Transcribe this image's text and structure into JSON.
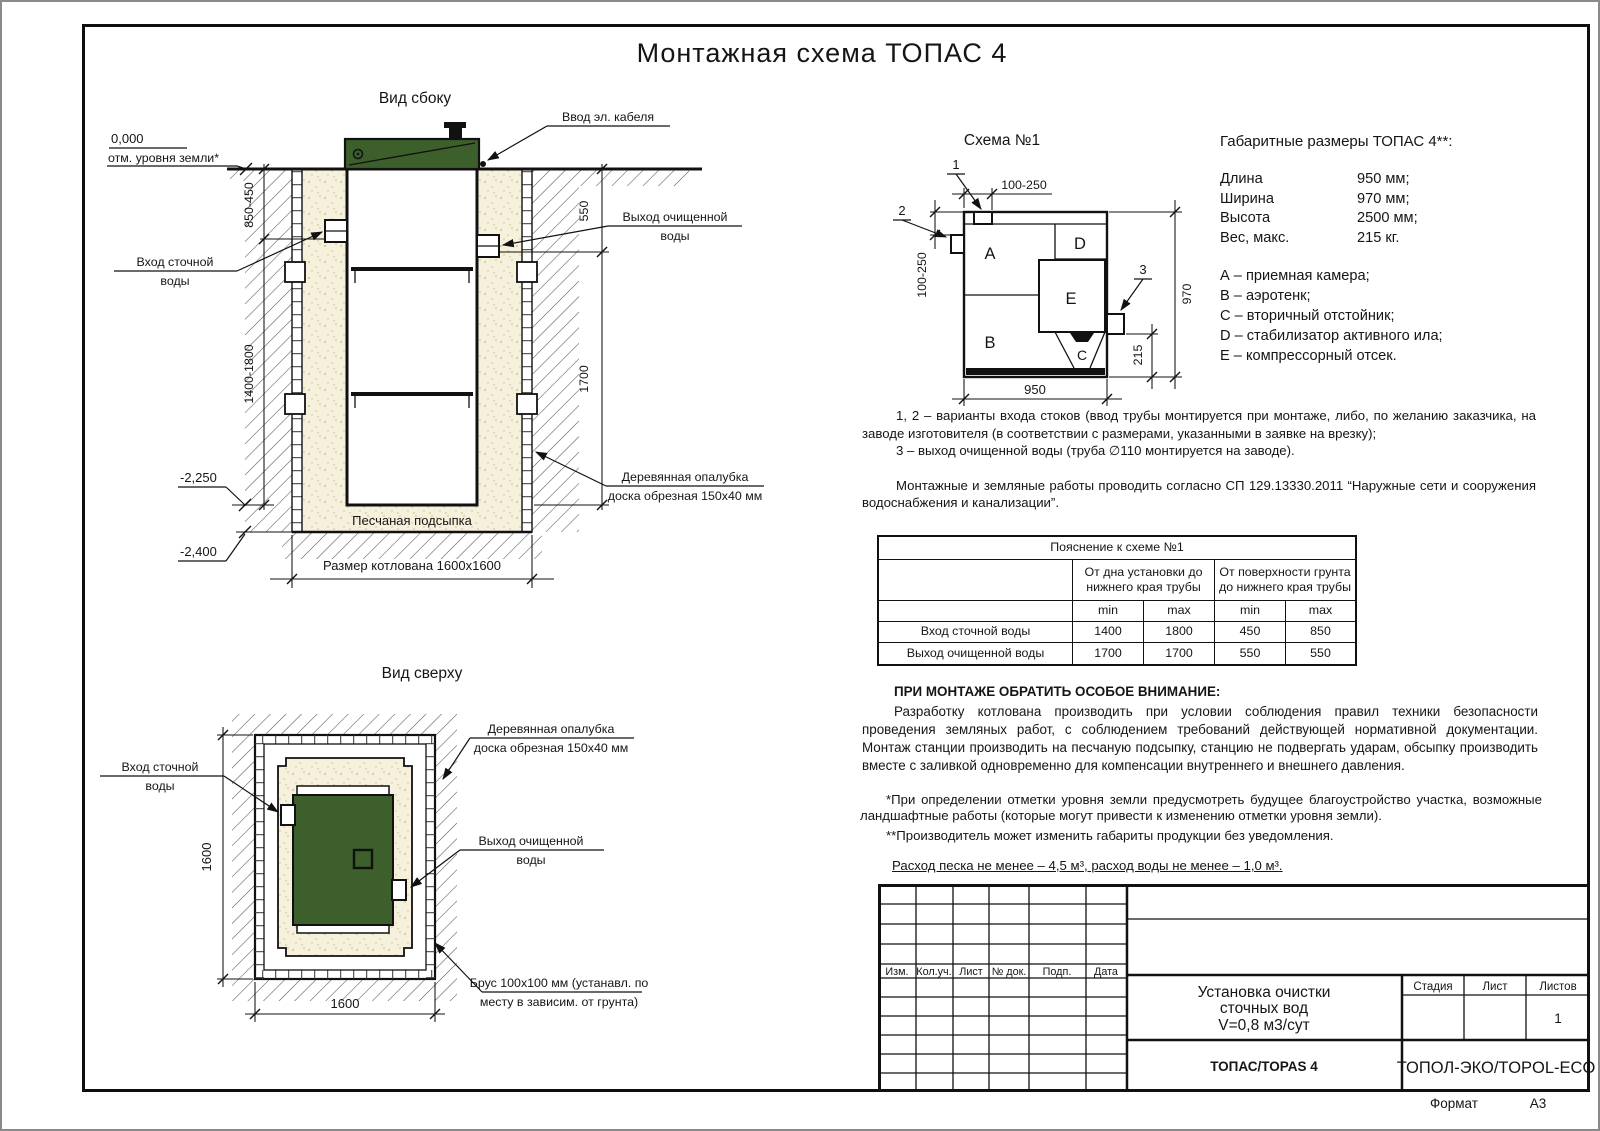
{
  "page": {
    "title": "Монтажная схема ТОПАС 4",
    "format_label": "Формат",
    "format_value": "А3"
  },
  "side_view": {
    "title": "Вид сбоку",
    "cable": "Ввод эл. кабеля",
    "zero": "0,000",
    "ground": "отм. уровня земли*",
    "inlet1": "Вход сточной",
    "inlet2": "воды",
    "outlet1": "Выход очищенной",
    "outlet2": "воды",
    "formwork1": "Деревянная опалубка",
    "formwork2": "доска обрезная 150х40 мм",
    "sand": "Песчаная подсыпка",
    "pit": "Размер котлована 1600х1600",
    "dim_depth1": "850-450",
    "dim_depth2": "1400-1800",
    "dim_out1": "550",
    "dim_out2": "1700",
    "lvl1": "-2,250",
    "lvl2": "-2,400"
  },
  "top_view": {
    "title": "Вид сверху",
    "inlet1": "Вход сточной",
    "inlet2": "воды",
    "outlet1": "Выход очищенной",
    "outlet2": "воды",
    "formwork1": "Деревянная опалубка",
    "formwork2": "доска обрезная 150х40 мм",
    "brus1": "Брус 100х100 мм (устанавл. по",
    "brus2": "месту в зависим. от грунта)",
    "dim_v": "1600",
    "dim_h": "1600"
  },
  "schema": {
    "title": "Схема №1",
    "p1": "1",
    "p2": "2",
    "p3": "3",
    "a": "A",
    "b": "B",
    "c": "C",
    "d": "D",
    "e": "E",
    "dim_top": "100-250",
    "dim_left": "100-250",
    "dim_right": "970",
    "dim_offset": "215",
    "dim_bottom": "950"
  },
  "specs": {
    "title": "Габаритные размеры ТОПАС 4**:",
    "rows": [
      {
        "label": "Длина",
        "value": "950 мм;"
      },
      {
        "label": "Ширина",
        "value": "970 мм;"
      },
      {
        "label": "Высота",
        "value": "2500 мм;"
      },
      {
        "label": "Вес, макс.",
        "value": "215 кг."
      }
    ],
    "legend": [
      "А – приемная камера;",
      "В – аэротенк;",
      "С – вторичный отстойник;",
      "D – стабилизатор активного ила;",
      "Е – компрессорный отсек."
    ]
  },
  "notes": {
    "n12": "1, 2 – варианты входа  стоков (ввод трубы монтируется при монтаже, либо, по желанию заказчика, на заводе изготовителя (в соответствии с размерами, указанными в заявке на врезку);",
    "n3": "3 – выход очищенной воды (труба ∅110 монтируется на заводе).",
    "sp": "Монтажные и земляные работы проводить согласно СП 129.13330.2011 “Наружные сети и сооружения водоснабжения и канализации”."
  },
  "table": {
    "title": "Пояснение к схеме №1",
    "group1": "От дна установки до нижнего края трубы",
    "group2": "От поверхности грунта до нижнего края трубы",
    "min1": "min",
    "max1": "max",
    "min2": "min",
    "max2": "max",
    "rows": [
      {
        "label": "Вход сточной воды",
        "c1": "1400",
        "c2": "1800",
        "c3": "450",
        "c4": "850"
      },
      {
        "label": "Выход очищенной воды",
        "c1": "1700",
        "c2": "1700",
        "c3": "550",
        "c4": "550"
      }
    ]
  },
  "attention": {
    "heading": "ПРИ МОНТАЖЕ ОБРАТИТЬ ОСОБОЕ ВНИМАНИЕ:",
    "body": "Разработку котлована производить при условии соблюдения правил техники безопасности проведения земляных работ, с соблюдением требований действующей нормативной документации. Монтаж станции производить на песчаную подсыпку, станцию не подвергать ударам, обсыпку производить вместе с заливкой одновременно для компенсации внутреннего и внешнего давления."
  },
  "footnotes": {
    "f1": "*При определении отметки уровня земли предусмотреть будущее благоустройство участка, возможные ландшафтные работы (которые могут привести к изменению отметки уровня земли).",
    "f2": "**Производитель может изменить габариты продукции без уведомления.",
    "consumption": "Расход песка не менее – 4,5 м³, расход воды не менее – 1,0 м³."
  },
  "titleblock": {
    "cols": [
      "Изм.",
      "Кол.уч.",
      "Лист",
      "№ док.",
      "Подп.",
      "Дата"
    ],
    "doc1": "Установка очистки",
    "doc2": "сточных вод",
    "doc3": "V=0,8 м3/сут",
    "stage": "Стадия",
    "sheet": "Лист",
    "sheets": "Листов",
    "sheets_value": "1",
    "model": "ТОПАС/TOPAS 4",
    "company": "ТОПОЛ-ЭКО/TOPOL-ECO"
  },
  "colors": {
    "lid_green": "#3c5f2b",
    "sand": "#f6f1dd",
    "line": "#111111"
  }
}
